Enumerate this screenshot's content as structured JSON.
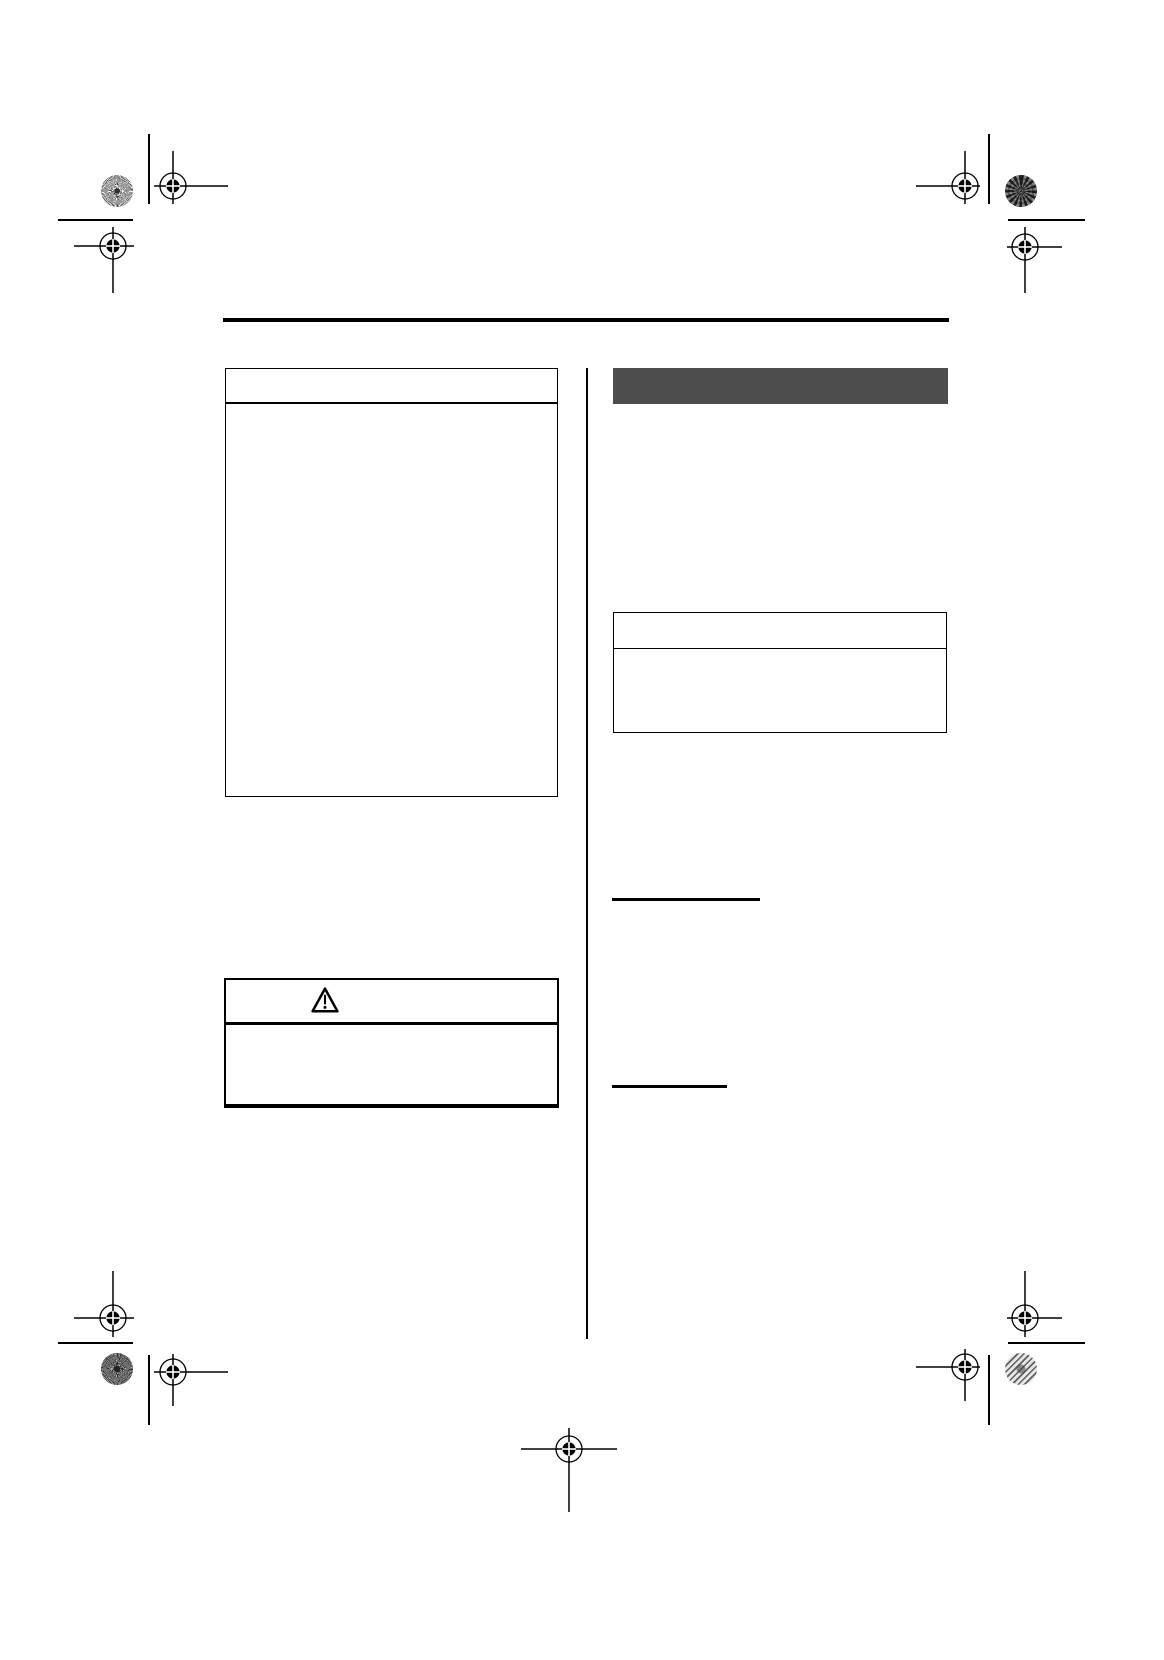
{
  "document": {
    "kind": "blank-manual-page-press-proof",
    "background_color": "#ffffff",
    "ink_color": "#000000",
    "section_bar_color": "#4d4d4d"
  },
  "content": {
    "left_column": {
      "note_box": {
        "header_rule": true,
        "body_text": ""
      },
      "warning_box": {
        "icon": "warning-triangle-icon",
        "header_rule": true,
        "body_text": ""
      }
    },
    "right_column": {
      "section_bar": {
        "label": ""
      },
      "info_box": {
        "header_rule": true,
        "body_text": ""
      },
      "fill_lines_count": 2
    }
  },
  "printers_marks": {
    "targets": [
      {
        "name": "reg-target-top-left-upper",
        "cx": 173,
        "cy": 186,
        "h": [
          154,
          228
        ],
        "v": [
          151,
          204
        ]
      },
      {
        "name": "reg-target-top-left-lower",
        "cx": 113,
        "cy": 246,
        "h": [
          74,
          134
        ],
        "v": [
          227,
          293
        ]
      },
      {
        "name": "reg-target-top-right-upper",
        "cx": 965,
        "cy": 186,
        "h": [
          916,
          980
        ],
        "v": [
          151,
          204
        ]
      },
      {
        "name": "reg-target-top-right-lower",
        "cx": 1025,
        "cy": 247,
        "h": [
          1007,
          1062
        ],
        "v": [
          227,
          293
        ]
      },
      {
        "name": "reg-target-bottom-left-upper",
        "cx": 113,
        "cy": 1318,
        "h": [
          74,
          134
        ],
        "v": [
          1271,
          1337
        ]
      },
      {
        "name": "reg-target-bottom-left-lower",
        "cx": 173,
        "cy": 1372,
        "h": [
          154,
          228
        ],
        "v": [
          1354,
          1406
        ]
      },
      {
        "name": "reg-target-bottom-right-upper",
        "cx": 1025,
        "cy": 1318,
        "h": [
          1007,
          1062
        ],
        "v": [
          1271,
          1337
        ]
      },
      {
        "name": "reg-target-bottom-right-lower",
        "cx": 965,
        "cy": 1367,
        "h": [
          916,
          980
        ],
        "v": [
          1349,
          1401
        ]
      },
      {
        "name": "reg-target-bottom-center",
        "cx": 569,
        "cy": 1449,
        "h": [
          521,
          617
        ],
        "v": [
          1428,
          1512
        ]
      }
    ],
    "target_style": {
      "outer_radius": 13,
      "inner_radius": 6.6,
      "line_width": 1.5,
      "ring_width": 1.3
    },
    "patches": [
      {
        "name": "calibration-patch-top-left",
        "cx": 117,
        "cy": 191,
        "r": 16,
        "pattern": "sunburst-fine"
      },
      {
        "name": "calibration-patch-top-right",
        "cx": 1021,
        "cy": 191,
        "r": 16,
        "pattern": "checker-dark"
      },
      {
        "name": "calibration-patch-bottom-left",
        "cx": 117,
        "cy": 1369,
        "r": 16,
        "pattern": "sunburst-dark"
      },
      {
        "name": "calibration-patch-bottom-right",
        "cx": 1021,
        "cy": 1369,
        "r": 16,
        "pattern": "stripes-light"
      }
    ],
    "trim_lines": [
      {
        "name": "trim-line-top-left-vertical",
        "x": 148,
        "y": 134,
        "w": 1.6,
        "h": 70
      },
      {
        "name": "trim-line-top-left-horizontal",
        "x": 58,
        "y": 219,
        "w": 75,
        "h": 2
      },
      {
        "name": "trim-line-top-right-vertical",
        "x": 988,
        "y": 134,
        "w": 1.6,
        "h": 70
      },
      {
        "name": "trim-line-top-right-horizontal",
        "x": 1008,
        "y": 219,
        "w": 77,
        "h": 2
      },
      {
        "name": "trim-line-bottom-left-vertical",
        "x": 148,
        "y": 1355,
        "w": 1.6,
        "h": 70
      },
      {
        "name": "trim-line-bottom-left-horizontal",
        "x": 58,
        "y": 1342,
        "w": 75,
        "h": 2
      },
      {
        "name": "trim-line-bottom-right-vertical",
        "x": 988,
        "y": 1355,
        "w": 1.6,
        "h": 70
      },
      {
        "name": "trim-line-bottom-right-horizontal",
        "x": 1008,
        "y": 1342,
        "w": 77,
        "h": 2
      }
    ]
  }
}
